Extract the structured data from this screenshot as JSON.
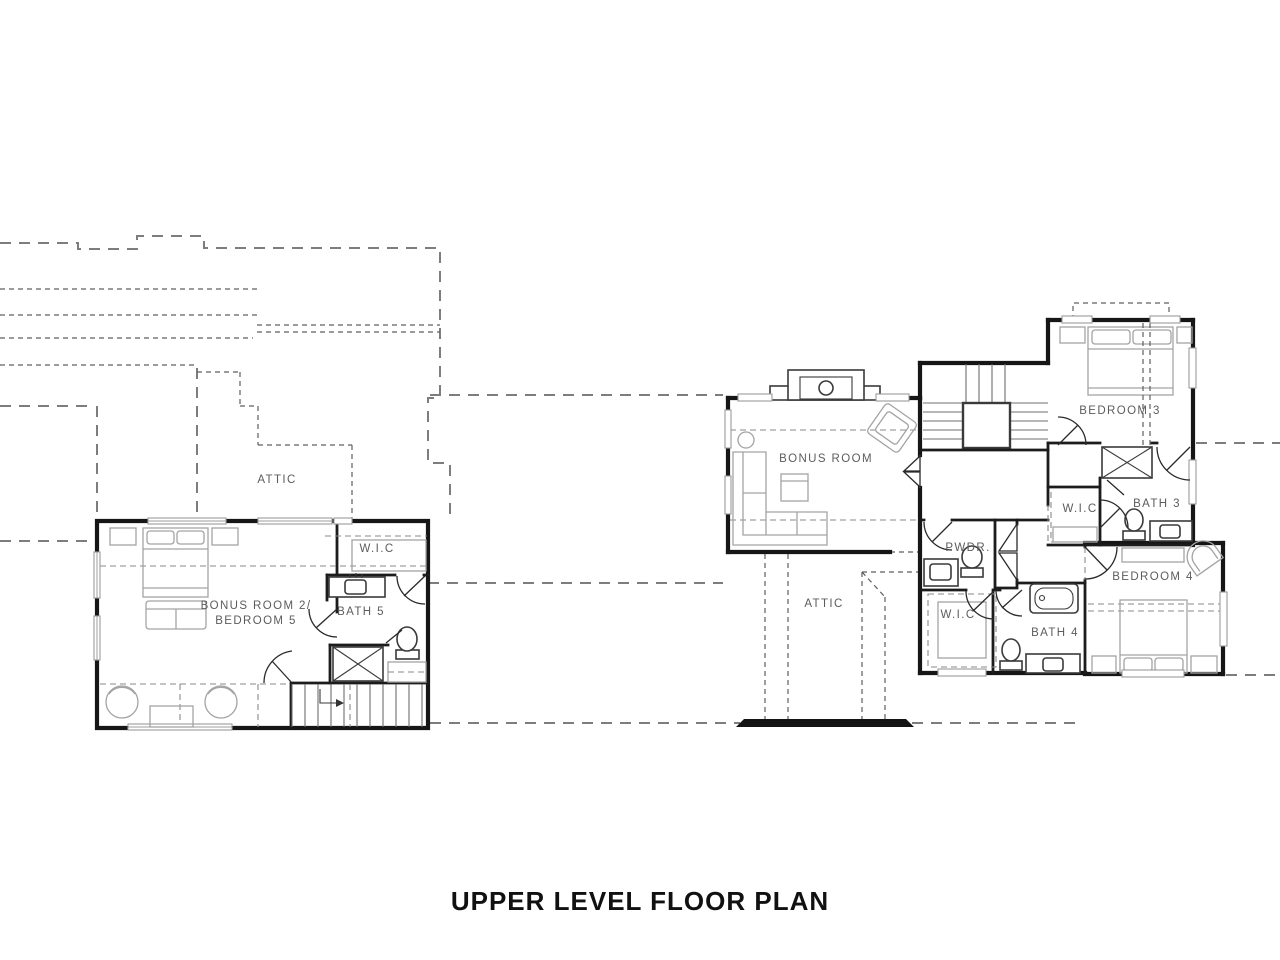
{
  "title": "UPPER LEVEL FLOOR PLAN",
  "colors": {
    "background": "#ffffff",
    "wall": "#161616",
    "furniture_line": "#a3a3a3",
    "fixture_line": "#3a3a3a",
    "dashed_line": "#7d7d7d",
    "label_text": "#5c5c5c",
    "title_text": "#111111"
  },
  "labels": {
    "attic_left": "ATTIC",
    "attic_middle": "ATTIC",
    "bonus_room_2_line1": "BONUS ROOM 2/",
    "bonus_room_2_line2": "BEDROOM 5",
    "wic_5": "W.I.C",
    "bath_5": "BATH 5",
    "bonus_room": "BONUS ROOM",
    "powder": "PWDR.",
    "bedroom_3": "BEDROOM 3",
    "bath_3": "BATH 3",
    "wic_3": "W.I.C",
    "bedroom_4": "BEDROOM 4",
    "bath_4": "BATH 4",
    "wic_4": "W.I.C"
  }
}
